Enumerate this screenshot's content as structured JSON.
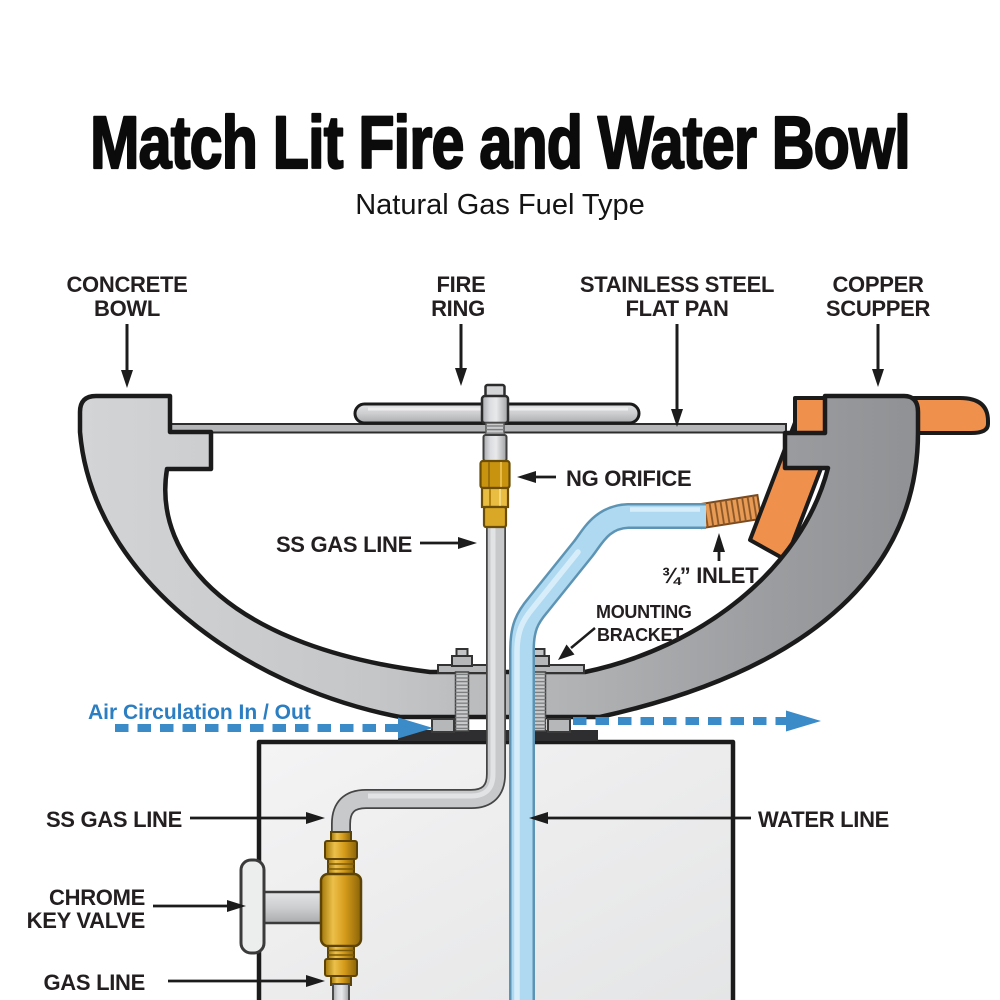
{
  "header": {
    "title": "Match Lit Fire and Water Bowl",
    "subtitle": "Natural Gas Fuel Type"
  },
  "callouts": {
    "concrete_bowl": {
      "line1": "CONCRETE",
      "line2": "BOWL"
    },
    "fire_ring": {
      "line1": "FIRE",
      "line2": "RING"
    },
    "flat_pan": {
      "line1": "STAINLESS STEEL",
      "line2": "FLAT PAN"
    },
    "copper_scupper": {
      "line1": "COPPER",
      "line2": "SCUPPER"
    },
    "ng_orifice": {
      "text": "NG ORIFICE"
    },
    "ss_gas_line_upper": {
      "text": "SS GAS LINE"
    },
    "inlet": {
      "text": "¾” INLET"
    },
    "mounting_bracket": {
      "line1": "MOUNTING",
      "line2": "BRACKET"
    },
    "air_circulation": {
      "text": "Air Circulation In / Out"
    },
    "water_line": {
      "text": "WATER LINE"
    },
    "ss_gas_line_lower": {
      "text": "SS GAS LINE"
    },
    "chrome_key_valve": {
      "line1": "CHROME",
      "line2": "KEY VALVE"
    },
    "gas_line": {
      "text": "GAS LINE"
    }
  },
  "colors": {
    "label_text": "#231f20",
    "arrow_black": "#1c1c1c",
    "air_blue": "#3b8bc9",
    "air_text_blue": "#2b7ec2",
    "copper_orange": "#ef914c",
    "water_blue": "#aed9f0",
    "brass_gold": "#d89a1f",
    "bowl_gray_light": "#cfd1d3",
    "bowl_gray_dark": "#8f9194",
    "pedestal_gray": "#ececed",
    "outline_dark": "#1b1b1b"
  }
}
